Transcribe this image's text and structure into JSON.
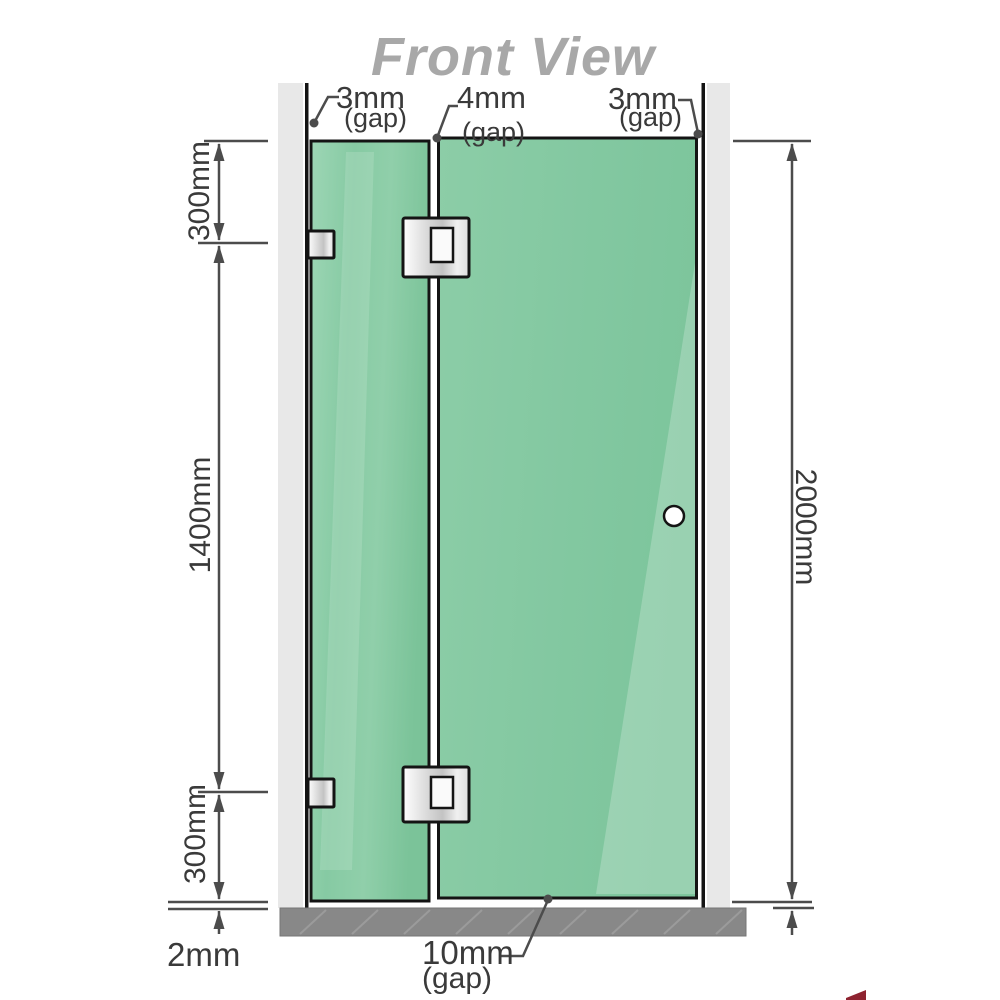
{
  "title": "Front View",
  "annotations": {
    "gap_top_left": {
      "value": "3mm",
      "suffix": "(gap)"
    },
    "gap_top_middle": {
      "value": "4mm",
      "suffix": "(gap)"
    },
    "gap_top_right": {
      "value": "3mm",
      "suffix": "(gap)"
    },
    "left_top_segment": "300mm",
    "left_middle_segment": "1400mm",
    "left_bottom_segment": "300mm",
    "right_total_height": "2000mm",
    "floor_gap_left": "2mm",
    "floor_gap_bottom": {
      "value": "10mm",
      "suffix": "(gap)"
    }
  },
  "colors": {
    "title": "#a8a8a8",
    "label": "#3a3a3a",
    "dimension": "#4c4c4c",
    "outline": "#141414",
    "wall_channel": "#e8e8e8",
    "floor": "#888888",
    "floor_hatch": "#a0a0a0",
    "glass": "#86caa3",
    "artifact_red": "#8e2330"
  }
}
